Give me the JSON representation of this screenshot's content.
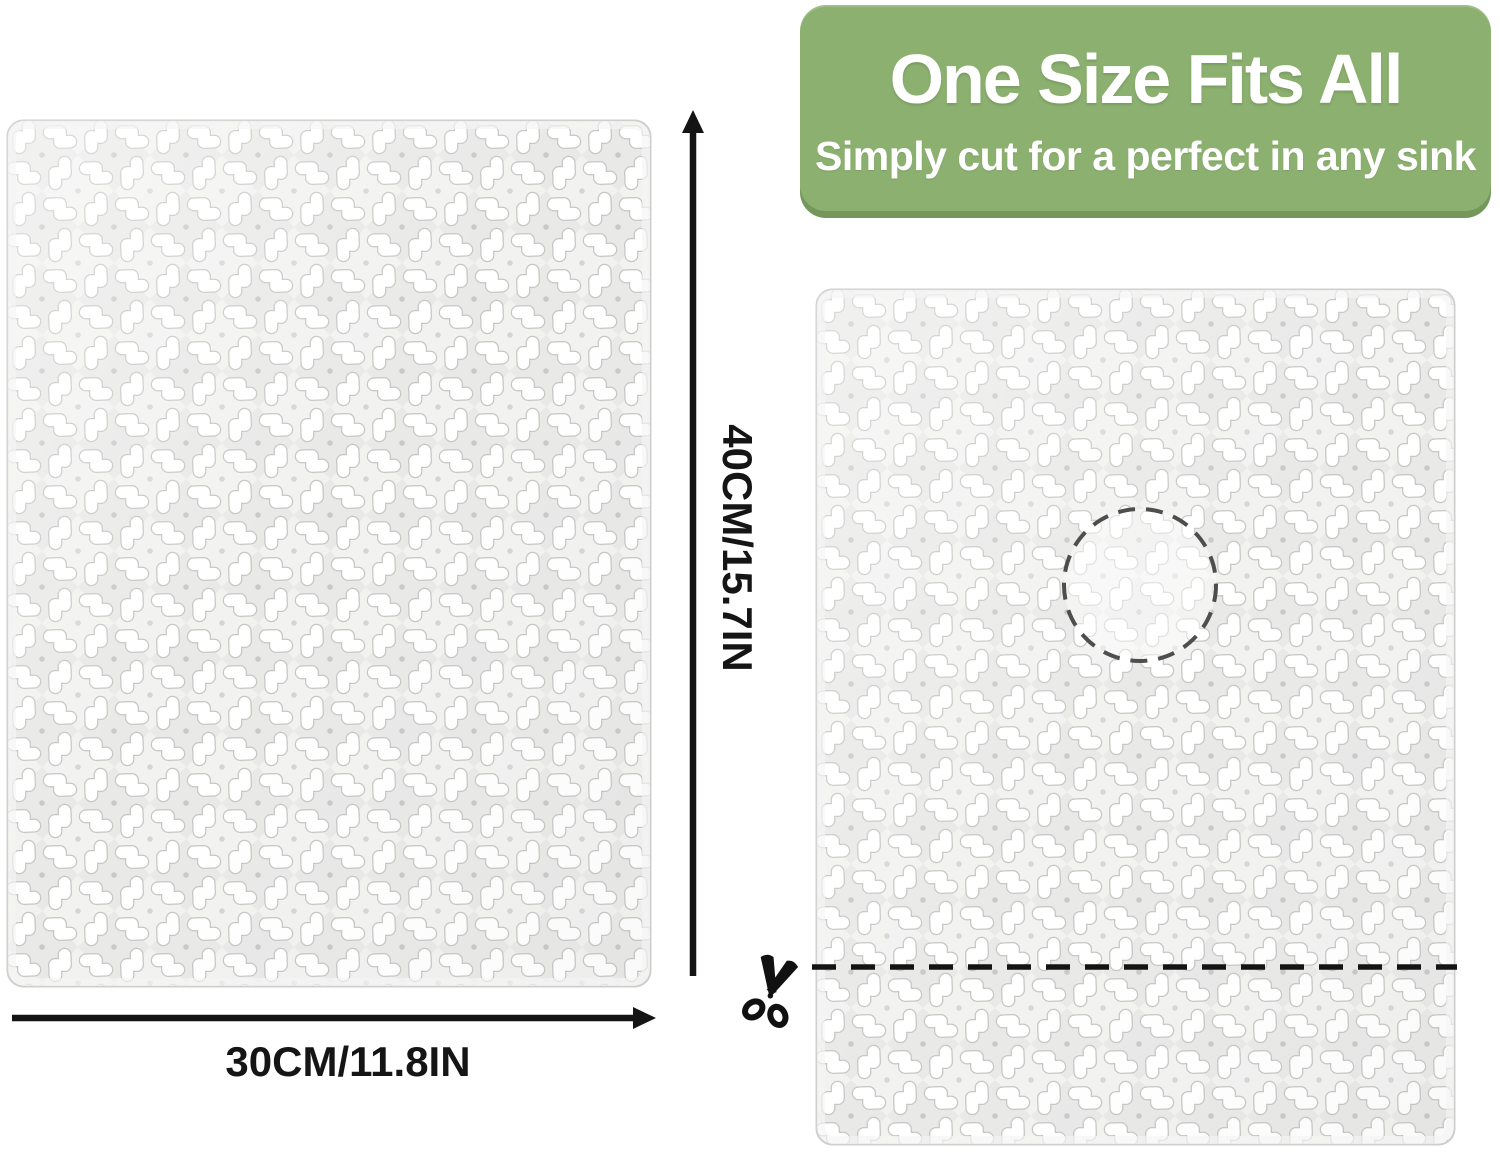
{
  "banner": {
    "title": "One Size Fits All",
    "subtitle": "Simply cut for a perfect in any sink",
    "background_color": "#8cb06f",
    "text_color": "#ffffff"
  },
  "dimension_labels": {
    "height": "40CM/15.7IN",
    "width": "30CM/11.8IN"
  },
  "guides": {
    "drain_cutout": "dashed-circle",
    "cut_line": "dashed-line",
    "cut_tool_icon": "scissors-icon",
    "height_arrow_icon": "up-arrow-icon",
    "width_arrow_icon": "right-arrow-icon"
  },
  "colors": {
    "mat_base": "#f2f2f1",
    "mat_diamond": "#e9e9e8",
    "mat_cutout": "#ffffff",
    "mat_outline": "#c6c6c4",
    "arrow_and_cutline": "#141414",
    "dashed_circle": "#4e4e4e"
  }
}
